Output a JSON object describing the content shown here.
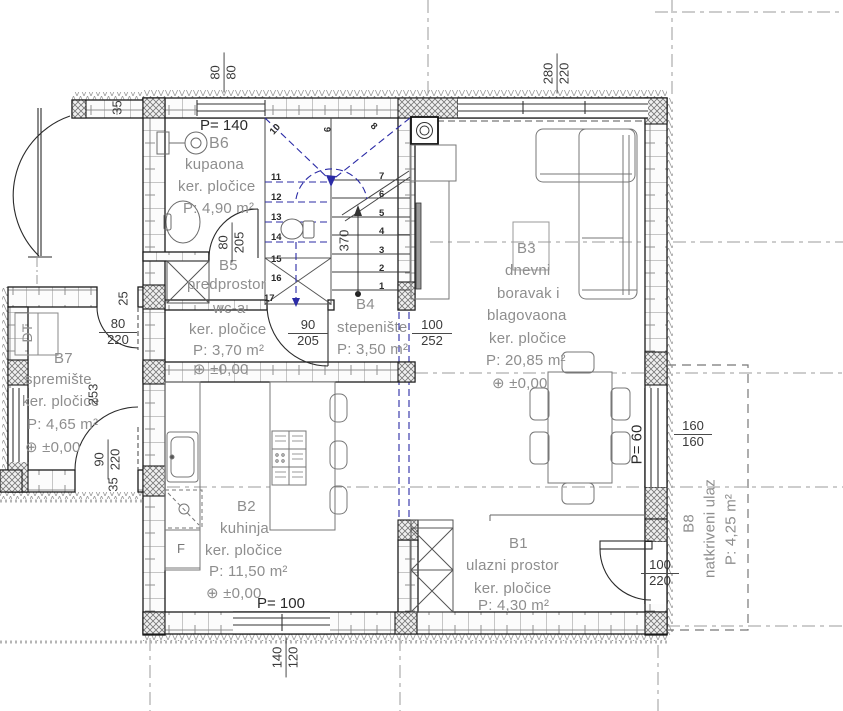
{
  "symbols": {
    "level_marker": "⊕"
  },
  "rooms": {
    "b6": {
      "id": "B6",
      "name": "kupaona",
      "floor": "ker. pločice",
      "area": "P: 4,90 m²",
      "parapet": "P= 140"
    },
    "b5": {
      "id": "B5",
      "name": "predprostor",
      "name2": "wc-a",
      "floor": "ker. pločice",
      "area": "P: 3,70 m²",
      "level": "±0,00"
    },
    "b4": {
      "id": "B4",
      "name": "stepenište",
      "area": "P: 3,50 m²"
    },
    "b3": {
      "id": "B3",
      "name_line1": "dnevni",
      "name_line2": "boravak i",
      "name_line3": "blagovaona",
      "floor": "ker. pločice",
      "area": "P: 20,85 m²",
      "level": "±0,00"
    },
    "b2": {
      "id": "B2",
      "name": "kuhinja",
      "floor": "ker. pločice",
      "area": "P: 11,50 m²",
      "level": "±0,00",
      "parapet": "P= 100"
    },
    "b1": {
      "id": "B1",
      "name": "ulazni prostor",
      "floor": "ker. pločice",
      "area": "P: 4,30 m²"
    },
    "b7": {
      "id": "B7",
      "name": "spremište",
      "floor": "ker. pločice",
      "area": "P: 4,65 m²",
      "level": "±0,00",
      "cabinet_label": "DT"
    },
    "b8": {
      "id": "B8",
      "name": "natkriveni ulaz",
      "area": "P: 4,25 m²",
      "parapet": "P= 60"
    }
  },
  "dimensions": {
    "window_top_small": {
      "w": "80",
      "h": "80"
    },
    "window_top_large": {
      "w": "280",
      "h": "220"
    },
    "door_bathroom": {
      "w": "80",
      "h": "205"
    },
    "door_wc": {
      "w": "90",
      "h": "205"
    },
    "stairs_opening": {
      "w": "100",
      "h": "252"
    },
    "stairs_run": "370",
    "door_b7_upper": {
      "w": "80",
      "h": "220"
    },
    "door_b7_lower": {
      "w": "90",
      "h": "220"
    },
    "b7_length": "253",
    "wall_25": "25",
    "wall_35_top": "35",
    "wall_35_bottom": "35",
    "window_right": {
      "w": "160",
      "h": "160"
    },
    "door_entrance": {
      "w": "100",
      "h": "220"
    },
    "window_bottom": {
      "w": "140",
      "h": "120"
    }
  },
  "stairs": {
    "lower_steps": [
      "1",
      "2",
      "3",
      "4",
      "5",
      "6",
      "7"
    ],
    "winder_steps": [
      "8",
      "9",
      "10"
    ],
    "upper_steps": [
      "11",
      "12",
      "13",
      "14",
      "15",
      "16",
      "17"
    ]
  },
  "appliances": {
    "fridge": "F"
  }
}
